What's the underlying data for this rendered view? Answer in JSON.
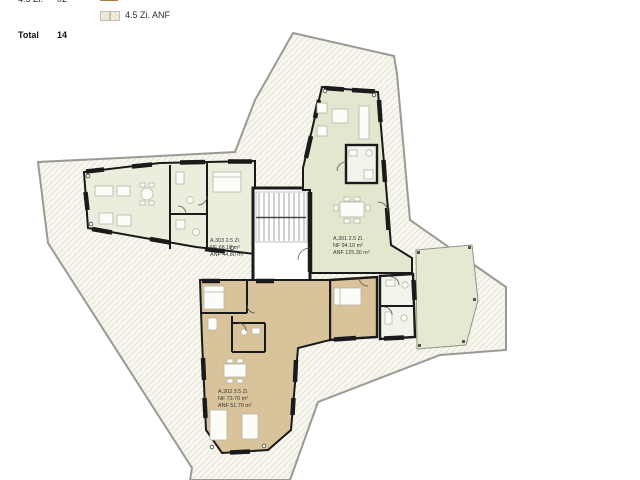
{
  "legend": {
    "partial_row": {
      "left_label": "4.5 Zi.",
      "left_count": "02",
      "right_label": "4.5 Zi."
    },
    "anf_row": {
      "label": "4.5 Zi. ANF"
    },
    "total": {
      "label": "Total",
      "count": "14"
    }
  },
  "apartments": {
    "a303": {
      "title": "A.303  2.5 Zi.",
      "nf": "NF 68.10 m²",
      "anf": "ANF 44.80 m²"
    },
    "a301": {
      "title": "A.301  2.5 Zi.",
      "nf": "NF 94.10 m²",
      "anf": "ANF 125.30 m²"
    },
    "a302": {
      "title": "A.302  3.5 Zi.",
      "nf": "NF 73.70 m²",
      "anf": "ANF 51.70 m²"
    }
  },
  "colors": {
    "apartment_green": "#e3e7cd",
    "apartment_green_light": "#eceedd",
    "apartment_tan": "#d9c39b",
    "terrace_green": "#e6e9d2",
    "legend_tan": "#e0a45c",
    "site_hatch_bg": "#f7f6ef",
    "wall": "#1a1a1a"
  }
}
